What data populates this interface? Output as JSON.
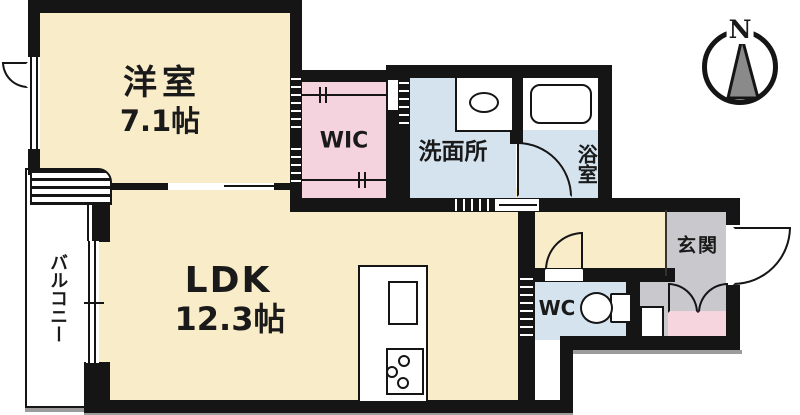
{
  "floorplan": {
    "rooms": {
      "western_room": {
        "label": "洋室",
        "area": "7.1帖"
      },
      "ldk": {
        "label": "LDK",
        "area": "12.3帖"
      },
      "wic": {
        "label": "WIC"
      },
      "washroom": {
        "label": "洗面所"
      },
      "bathroom": {
        "label": "浴室"
      },
      "balcony": {
        "label": "バルコニー"
      },
      "wc": {
        "label": "WC"
      },
      "entrance": {
        "label": "玄関"
      }
    },
    "compass": {
      "label": "N"
    },
    "colors": {
      "room_floor": "#F9ECC9",
      "closet_floor": "#F4D3DE",
      "wet_floor": "#D5E3EF",
      "entrance_floor": "#C9C9CD",
      "entrance_accent": "#F6D5DE",
      "wall": "#151515",
      "ink": "#1a1a1a"
    },
    "fixtures": [
      "bathtub",
      "washbasin",
      "toilet",
      "kitchen-counter",
      "kitchen-sink",
      "gas-stove",
      "hanger-rail",
      "louver-panel",
      "sliding-window",
      "hinged-door",
      "double-door-closet"
    ]
  }
}
